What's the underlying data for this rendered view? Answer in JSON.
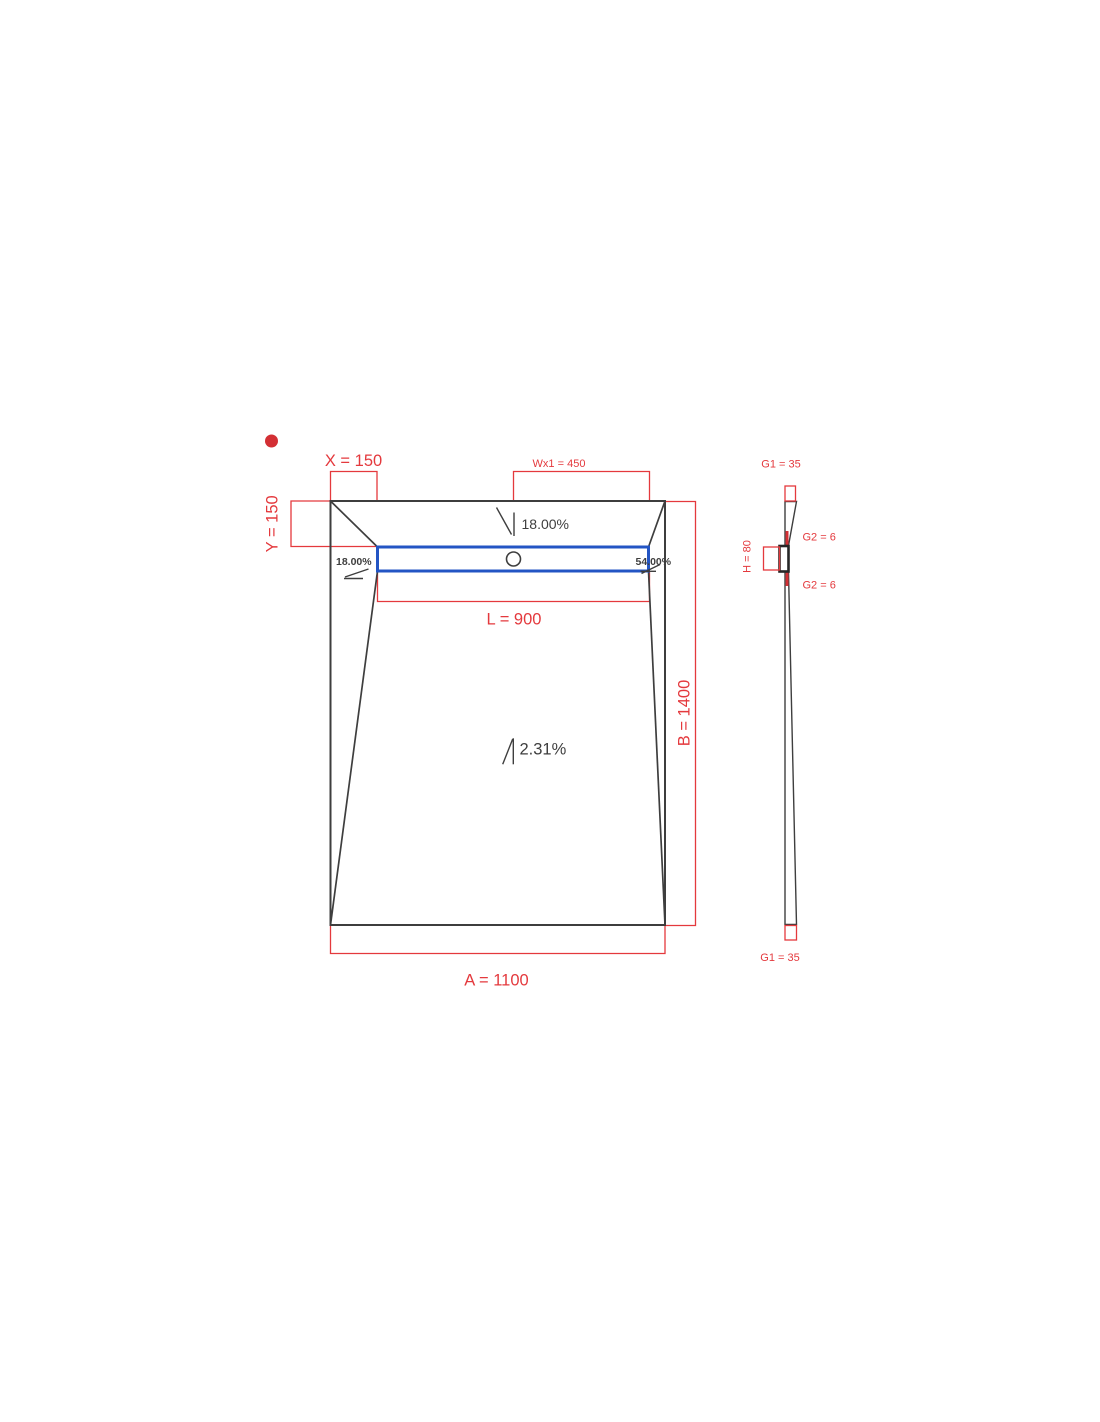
{
  "colors": {
    "background": "#ffffff",
    "dimension_red": "#e4393d",
    "marker_red": "#d32f34",
    "line_dark": "#3e3e3e",
    "drain_dark": "#262626",
    "channel_blue": "#2355c4"
  },
  "plan": {
    "dim_x": "X = 150",
    "dim_y": "Y = 150",
    "dim_wx1": "Wx1 = 450",
    "dim_l": "L = 900",
    "dim_b": "B = 1400",
    "dim_a": "A = 1100",
    "slope_top": "18.00%",
    "slope_left": "18.00%",
    "slope_right": "54.00%",
    "slope_main": "2.31%"
  },
  "side": {
    "dim_g1_top": "G1 = 35",
    "dim_g2_upper": "G2 = 6",
    "dim_h": "H = 80",
    "dim_g2_lower": "G2 = 6",
    "dim_g1_bottom": "G1 = 35"
  }
}
